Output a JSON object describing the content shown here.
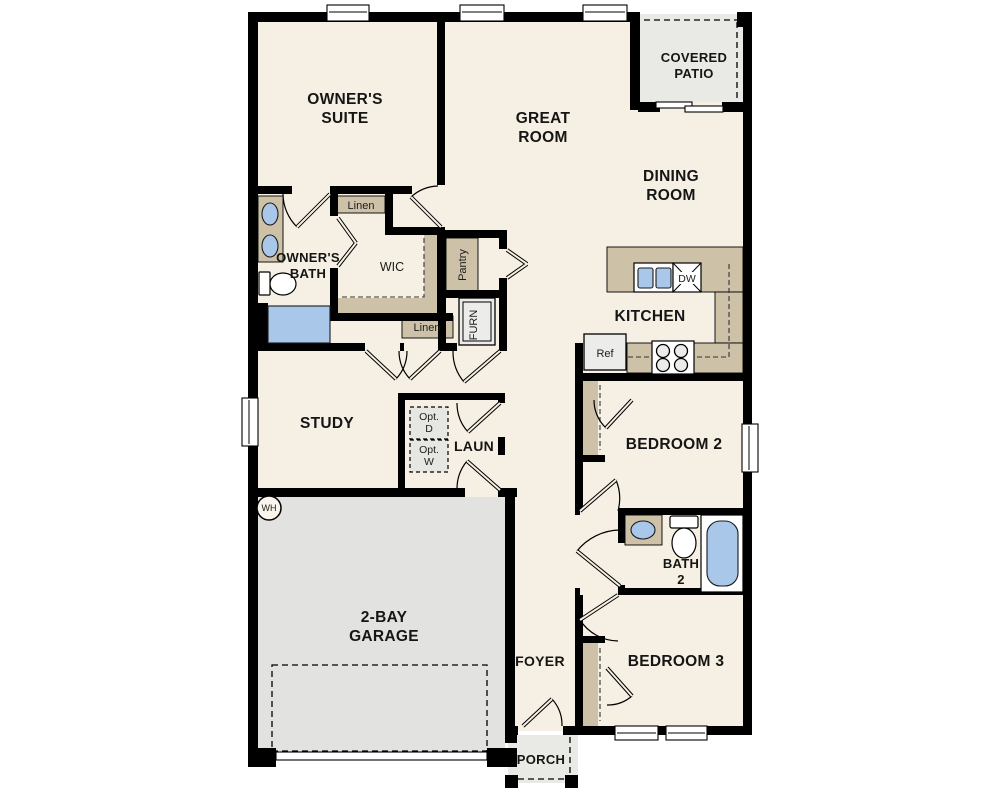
{
  "canvas": {
    "width": 1000,
    "height": 800,
    "background": "#ffffff"
  },
  "palette": {
    "wall": "#000000",
    "floor": "#f6efe3",
    "counter_tan": "#cdc1a8",
    "garage_gray": "#e2e2e0",
    "patio_gray": "#e9e9e5",
    "fixture_blue": "#a9c8e9",
    "appliance_gray": "#ececea"
  },
  "rooms": {
    "owners_suite": {
      "line1": "OWNER'S",
      "line2": "SUITE"
    },
    "great_room": {
      "line1": "GREAT",
      "line2": "ROOM"
    },
    "covered_patio": {
      "line1": "COVERED",
      "line2": "PATIO"
    },
    "dining_room": {
      "line1": "DINING",
      "line2": "ROOM"
    },
    "kitchen": {
      "label": "KITCHEN"
    },
    "owners_bath": {
      "line1": "OWNER'S",
      "line2": "BATH"
    },
    "wic": {
      "label": "WIC"
    },
    "study": {
      "label": "STUDY"
    },
    "laundry": {
      "label": "LAUN"
    },
    "bedroom_2": {
      "label": "BEDROOM 2"
    },
    "bath_2": {
      "line1": "BATH",
      "line2": "2"
    },
    "bedroom_3": {
      "label": "BEDROOM 3"
    },
    "garage": {
      "line1": "2-BAY",
      "line2": "GARAGE"
    },
    "foyer": {
      "label": "FOYER"
    },
    "porch": {
      "label": "PORCH"
    }
  },
  "closets": {
    "linen_upper": {
      "label": "Linen"
    },
    "linen_lower": {
      "label": "Linen"
    },
    "pantry": {
      "label": "Pantry"
    }
  },
  "appliances": {
    "furnace": {
      "label": "FURN"
    },
    "refrigerator": {
      "label": "Ref"
    },
    "dishwasher": {
      "label": "DW"
    },
    "water_heater": {
      "label": "WH"
    },
    "opt_dryer": {
      "line1": "Opt.",
      "line2": "D"
    },
    "opt_washer": {
      "line1": "Opt.",
      "line2": "W"
    }
  }
}
